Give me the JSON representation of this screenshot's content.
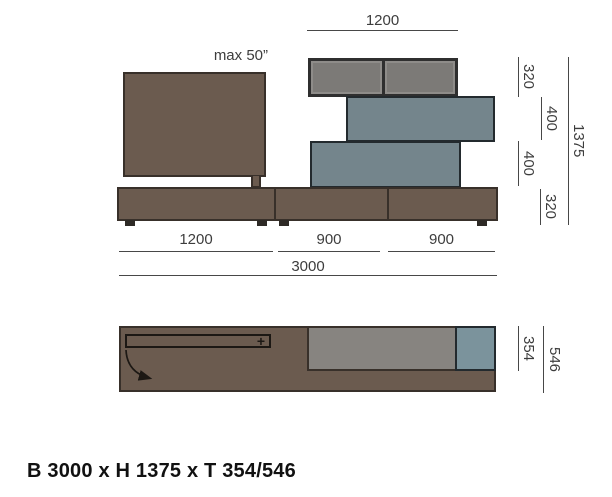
{
  "colors": {
    "brown": "#6b5b4f",
    "brown-border": "#38302a",
    "teal": "#74858c",
    "teal-border": "#232a2e",
    "teal-light": "#7b939c",
    "gray-shelf": "#878480",
    "frame-dark": "#2f2f2f",
    "compartment": "#7c7a77",
    "compartment-edge": "#8e8c89",
    "foot": "#2e2a26",
    "dim-line": "#474747",
    "dim-text": "#3d3d3d",
    "ink": "#1c1814"
  },
  "front_view": {
    "top_width": "1200",
    "tv_max_size": "max 50”",
    "height_segments": [
      "320",
      "400",
      "400",
      "320"
    ],
    "total_height": "1375",
    "bottom_segments": [
      "1200",
      "900",
      "900"
    ],
    "total_width": "3000"
  },
  "plan_view": {
    "open_symbol": "+",
    "depth_shallow": "354",
    "depth_total": "546"
  },
  "caption": "B 3000 x H 1375 x T 354/546"
}
